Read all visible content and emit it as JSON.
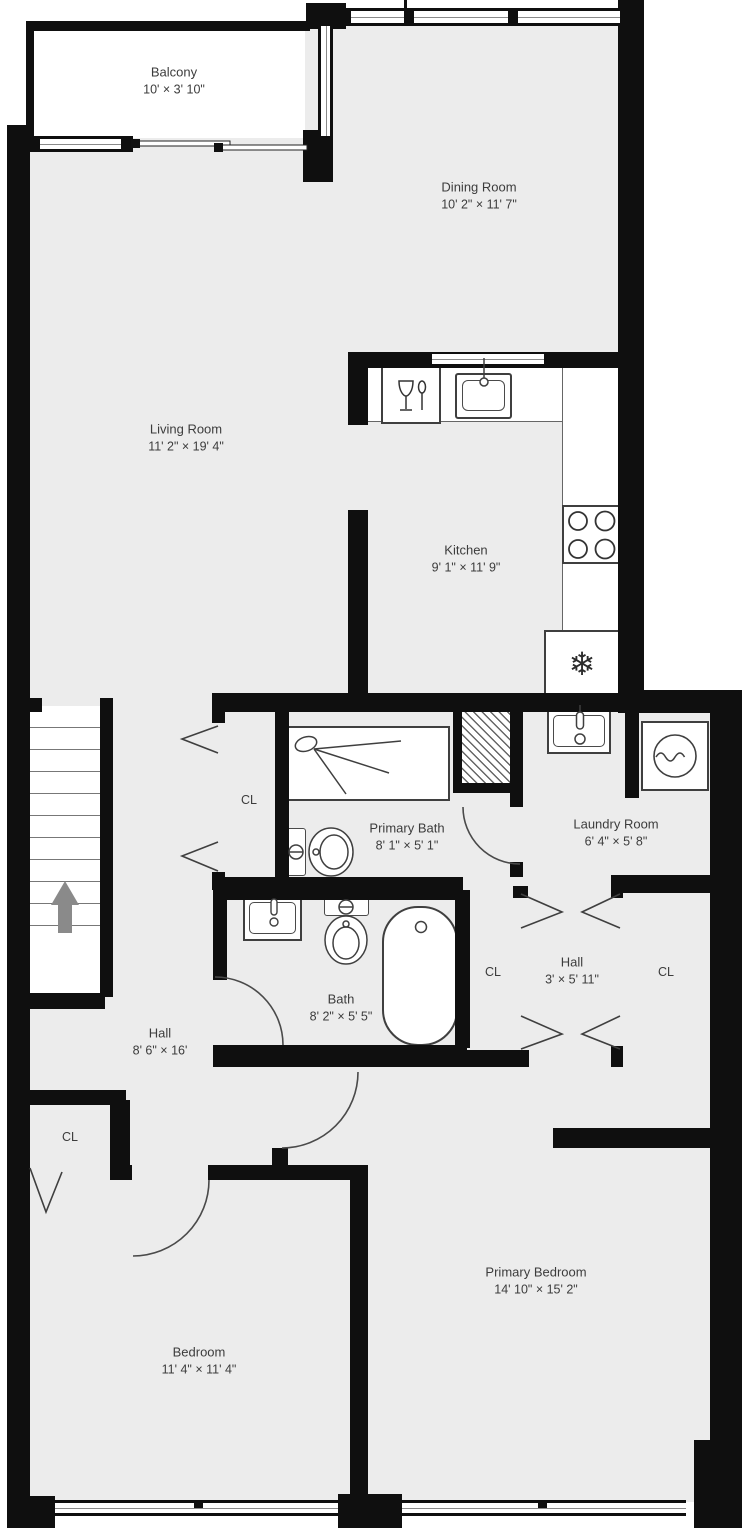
{
  "plan_type": "residential-floor-plan",
  "colors": {
    "floor": "#ececec",
    "wall": "#0f0f0f",
    "fixture_outline": "#3f3f3f",
    "stairs_arrow": "#8a8a8a",
    "label_text": "#3c3c3c",
    "background": "#ffffff"
  },
  "rooms": [
    {
      "name": "Balcony",
      "dims": "10' × 3' 10\""
    },
    {
      "name": "Dining Room",
      "dims": "10' 2\" × 11' 7\""
    },
    {
      "name": "Living Room",
      "dims": "11' 2\" × 19' 4\""
    },
    {
      "name": "Kitchen",
      "dims": "9' 1\" × 11' 9\""
    },
    {
      "name": "Primary Bath",
      "dims": "8' 1\" × 5' 1\""
    },
    {
      "name": "Laundry Room",
      "dims": "6' 4\" × 5' 8\""
    },
    {
      "name": "Hall",
      "dims": "3' × 5' 11\""
    },
    {
      "name": "Bath",
      "dims": "8' 2\" × 5' 5\""
    },
    {
      "name": "Hall",
      "dims": "8' 6\" × 16'"
    },
    {
      "name": "Bedroom",
      "dims": "11' 4\" × 11' 4\""
    },
    {
      "name": "Primary Bedroom",
      "dims": "14' 10\" × 15' 2\""
    }
  ],
  "closet_labels": [
    "CL",
    "CL",
    "CL",
    "CL"
  ],
  "glyphs": {
    "fridge": "❄"
  },
  "icons": [
    "snowflake-icon",
    "stove-burners-icon",
    "dishwasher-icon",
    "sink-icon",
    "toilet-icon",
    "bathtub-icon",
    "shower-head-icon",
    "washer-drum-icon",
    "up-arrow-icon",
    "bifold-door-chevrons",
    "door-swing-arc"
  ]
}
